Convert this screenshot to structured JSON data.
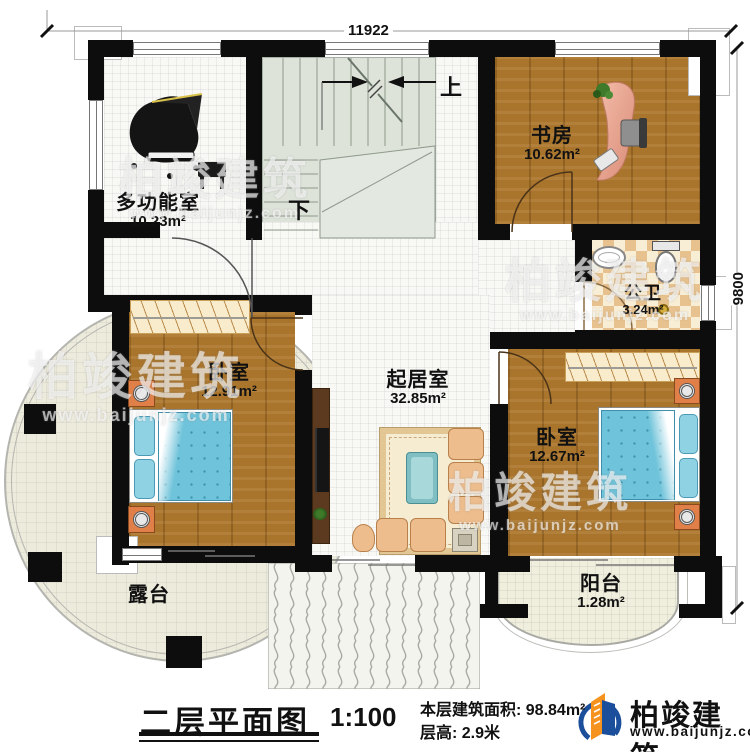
{
  "dimensions": {
    "top": "11922",
    "right": "9800"
  },
  "stairs": {
    "up": "上",
    "down": "下"
  },
  "rooms": {
    "multi": {
      "name": "多功能室",
      "area": "10.23m²"
    },
    "study": {
      "name": "书房",
      "area": "10.62m²"
    },
    "bath": {
      "name": "公卫",
      "area": "3.24m²"
    },
    "bedroom_left": {
      "name": "卧室",
      "area": "12.91m²"
    },
    "living": {
      "name": "起居室",
      "area": "32.85m²"
    },
    "bedroom_right": {
      "name": "卧室",
      "area": "12.67m²"
    },
    "terrace": {
      "name": "露台"
    },
    "balcony": {
      "name": "阳台",
      "area": "1.28m²"
    }
  },
  "title_block": {
    "title": "二层平面图",
    "scale": "1:100",
    "area_line": "本层建筑面积: 98.84m²",
    "height_line": "层高: 2.9米"
  },
  "logo": {
    "name": "柏竣建筑",
    "website": "www.baijunjz.com"
  },
  "watermark": {
    "name": "柏竣建筑",
    "website": "www.baijunjz.com"
  },
  "colors": {
    "wall": "#0d0d0d",
    "wood_floor": "#a9742c",
    "bed_blue": "#6fc3da",
    "logo_blue": "#1b4f9c",
    "logo_orange": "#f6921e"
  }
}
